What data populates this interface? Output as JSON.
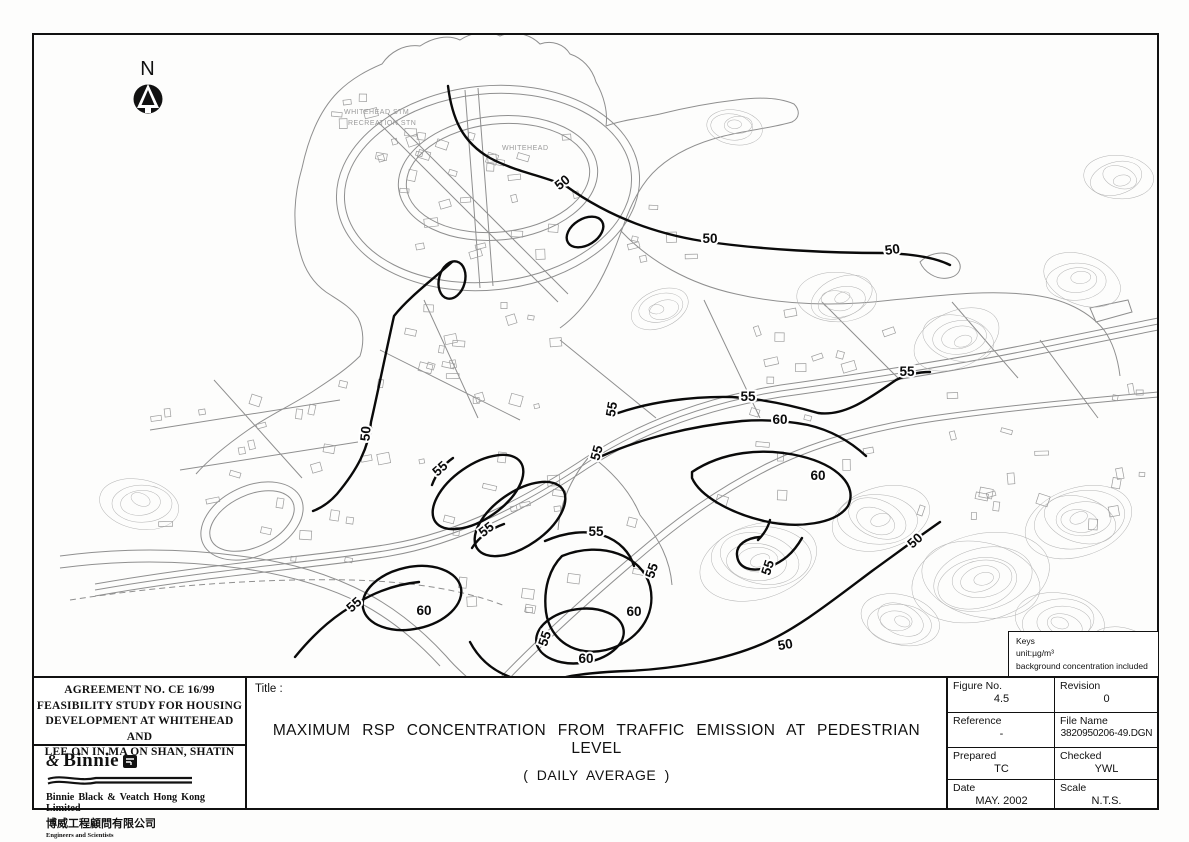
{
  "drawing": {
    "north_label": "N",
    "keys_box": {
      "title": "Keys",
      "unit": "unit:µg/m³",
      "note": "background concentration included"
    },
    "project_block": {
      "line1": "AGREEMENT NO. CE 16/99",
      "line2": "FEASIBILITY STUDY FOR HOUSING",
      "line3": "DEVELOPMENT AT WHITEHEAD AND",
      "line4": "LEE ON IN MA ON SHAN, SHATIN"
    },
    "company_block": {
      "amp": "&",
      "logo_text": "Binnie",
      "name": "Binnie Black & Veatch Hong Kong Limited",
      "name_zh": "博威工程顧問有限公司",
      "tagline": "Engineers and Scientists"
    },
    "title_block": {
      "label": "Title :",
      "line1": "MAXIMUM RSP CONCENTRATION FROM TRAFFIC EMISSION AT PEDESTRIAN LEVEL",
      "line2": "( DAILY AVERAGE )"
    },
    "info_block": {
      "figure_no_label": "Figure No.",
      "figure_no": "4.5",
      "revision_label": "Revision",
      "revision": "0",
      "reference_label": "Reference",
      "reference": "-",
      "file_name_label": "File Name",
      "file_name": "3820950206-49.DGN",
      "prepared_label": "Prepared",
      "prepared": "TC",
      "checked_label": "Checked",
      "checked": "YWL",
      "date_label": "Date",
      "date": "MAY. 2002",
      "scale_label": "Scale",
      "scale": "N.T.S."
    }
  },
  "map": {
    "unit_note": "concentration contours in µg/m³",
    "place_labels": [
      {
        "text": "WHITEHEAD STM",
        "x": 344,
        "y": 114
      },
      {
        "text": "RECREATION STN",
        "x": 348,
        "y": 125
      },
      {
        "text": "WHITEHEAD",
        "x": 502,
        "y": 150
      }
    ],
    "contour_labels": [
      {
        "value": "50",
        "x": 565,
        "y": 186,
        "rot": -38
      },
      {
        "value": "50",
        "x": 710,
        "y": 243,
        "rot": 0
      },
      {
        "value": "50",
        "x": 893,
        "y": 254,
        "rot": -8
      },
      {
        "value": "55",
        "x": 907,
        "y": 376,
        "rot": 0
      },
      {
        "value": "55",
        "x": 748,
        "y": 401,
        "rot": 0
      },
      {
        "value": "55",
        "x": 616,
        "y": 410,
        "rot": -80
      },
      {
        "value": "60",
        "x": 780,
        "y": 424,
        "rot": 0
      },
      {
        "value": "55",
        "x": 601,
        "y": 454,
        "rot": -75
      },
      {
        "value": "50",
        "x": 370,
        "y": 434,
        "rot": -85
      },
      {
        "value": "55",
        "x": 443,
        "y": 472,
        "rot": -42
      },
      {
        "value": "60",
        "x": 818,
        "y": 480,
        "rot": 0
      },
      {
        "value": "55",
        "x": 489,
        "y": 533,
        "rot": -38
      },
      {
        "value": "55",
        "x": 596,
        "y": 536,
        "rot": 0
      },
      {
        "value": "50",
        "x": 918,
        "y": 544,
        "rot": -42
      },
      {
        "value": "55",
        "x": 656,
        "y": 572,
        "rot": -72
      },
      {
        "value": "55",
        "x": 772,
        "y": 569,
        "rot": -72
      },
      {
        "value": "55",
        "x": 357,
        "y": 608,
        "rot": -42
      },
      {
        "value": "60",
        "x": 424,
        "y": 615,
        "rot": 0
      },
      {
        "value": "60",
        "x": 634,
        "y": 616,
        "rot": 0
      },
      {
        "value": "55",
        "x": 549,
        "y": 640,
        "rot": -72
      },
      {
        "value": "50",
        "x": 786,
        "y": 649,
        "rot": -10
      },
      {
        "value": "60",
        "x": 586,
        "y": 663,
        "rot": 0
      }
    ]
  }
}
